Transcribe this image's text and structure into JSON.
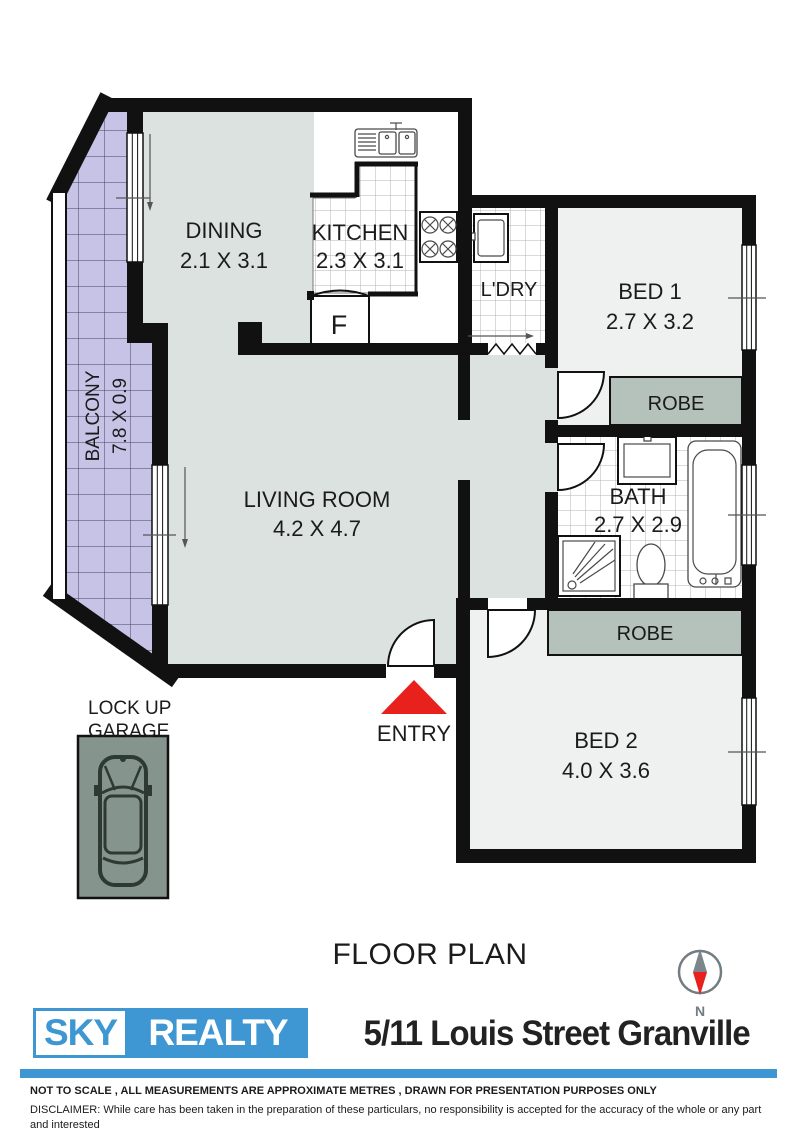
{
  "colors": {
    "wall": "#111111",
    "ink": "#1b1b1b",
    "roomGray": "#dce2df",
    "roomLight": "#eef1f0",
    "robe": "#b5c1bb",
    "garage": "#85948d",
    "balcony": "#c6c3e7",
    "balcLine": "#43435a",
    "tileLine": "#b3b3b3",
    "red": "#e8211d",
    "blue": "#3e97d3",
    "compass": "#737c80",
    "needleGray": "#7b858b",
    "carBody": "#2e3835"
  },
  "title": "FLOOR PLAN",
  "compass": {
    "label": "N"
  },
  "labels": {
    "dining": {
      "name": "DINING",
      "dims": "2.1 X 3.1"
    },
    "kitchen": {
      "name": "KITCHEN",
      "dims": "2.3 X 3.1"
    },
    "living": {
      "name": "LIVING ROOM",
      "dims": "4.2 X 4.7"
    },
    "balcony": {
      "name": "BALCONY",
      "dims": "7.8 X 0.9"
    },
    "laundry": {
      "name": "L'DRY"
    },
    "bed1": {
      "name": "BED 1",
      "dims": "2.7 X 3.2"
    },
    "bed2": {
      "name": "BED 2",
      "dims": "4.0 X 3.6"
    },
    "bath": {
      "name": "BATH",
      "dims": "2.7 X 2.9"
    },
    "robe1": {
      "name": "ROBE"
    },
    "robe2": {
      "name": "ROBE"
    },
    "fridge": {
      "name": "F"
    },
    "entry": {
      "name": "ENTRY"
    },
    "garage": {
      "line1": "LOCK UP",
      "line2": "GARAGE"
    }
  },
  "branding": {
    "logo_primary": "SKY",
    "logo_secondary": "REALTY",
    "address": "5/11 Louis Street Granville"
  },
  "footer": {
    "note": "NOT TO SCALE , ALL MEASUREMENTS ARE APPROXIMATE METRES , DRAWN FOR PRESENTATION PURPOSES ONLY",
    "disclaimer_line1": "DISCLAIMER:  While care has been taken in the preparation of these particulars, no responsibility is accepted for the accuracy of the whole or any part and interested",
    "disclaimer_line2": "persons are advised to make their own enquiries and satisfy themselves in all respects.",
    "credit": "Floor Plan by www.skcmarketing.com.au"
  }
}
